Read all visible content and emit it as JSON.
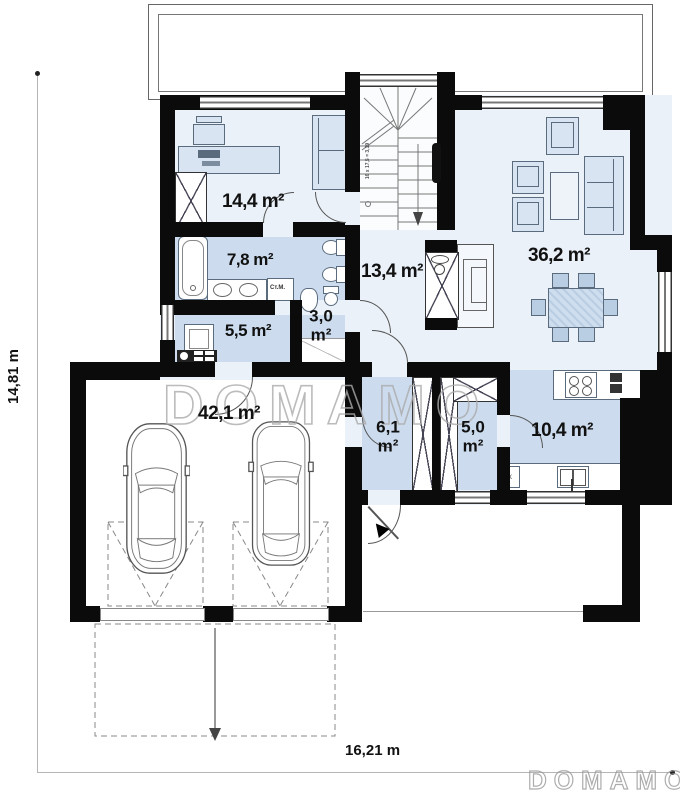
{
  "watermark": {
    "center_text": "DOMAMO",
    "logo_text": "DOMAMO"
  },
  "dimensions": {
    "horizontal": "16,21 m",
    "vertical": "14,81 m"
  },
  "rooms": [
    {
      "name": "bedroom-office",
      "area": "14,4 m²",
      "value": "14,4",
      "unit": "m²"
    },
    {
      "name": "bathroom",
      "area": "7,8 m²",
      "value": "7,8",
      "unit": "m²"
    },
    {
      "name": "utility-room",
      "area": "5,5 m²",
      "value": "5,5",
      "unit": "m²"
    },
    {
      "name": "wc",
      "area": "3,0 m²",
      "value": "3,0",
      "unit": "m²"
    },
    {
      "name": "hall",
      "area": "13,4 m²",
      "value": "13,4",
      "unit": "m²"
    },
    {
      "name": "living-room",
      "area": "36,2 m²",
      "value": "36,2",
      "unit": "m²"
    },
    {
      "name": "garage",
      "area": "42,1 m²",
      "value": "42,1",
      "unit": "m²"
    },
    {
      "name": "vestibule",
      "area": "6,1 m²",
      "value": "6,1",
      "unit": "m²"
    },
    {
      "name": "pantry",
      "area": "5,0 m²",
      "value": "5,0",
      "unit": "m²"
    },
    {
      "name": "kitchen",
      "area": "10,4 m²",
      "value": "10,4",
      "unit": "m²"
    }
  ],
  "annotations": {
    "washing_machine": "Ст.М.",
    "stairs_note": "16 x 17,5 = 3,19",
    "kitchen_box": "x"
  },
  "colors": {
    "wall": "#0b0b0b",
    "floor_light": "#eaf1f8",
    "floor_medium": "#ccdcee",
    "furniture": "#d9e4f2",
    "watermark": "#ababab"
  }
}
